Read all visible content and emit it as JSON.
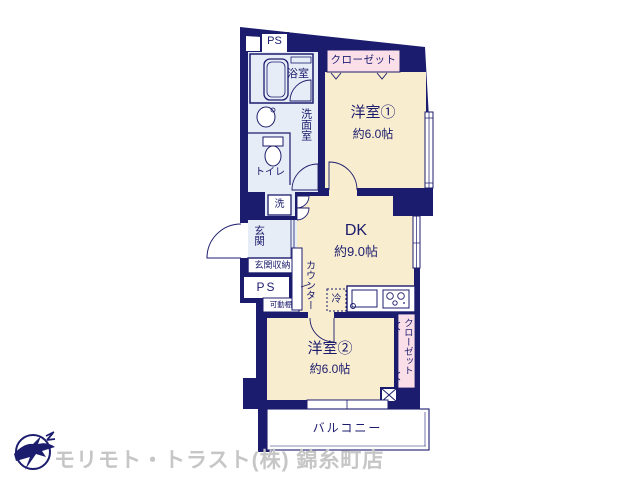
{
  "plan": {
    "rooms": {
      "room1": {
        "label": "洋室①",
        "size": "約6.0帖"
      },
      "dk": {
        "label": "DK",
        "size": "約9.0帖"
      },
      "room2": {
        "label": "洋室②",
        "size": "約6.0帖"
      }
    },
    "closet_top": {
      "label": "クローゼット"
    },
    "closet_right": {
      "label": "クローゼット"
    },
    "balcony": {
      "label": "バルコニー"
    },
    "bathroom": {
      "label": "浴室"
    },
    "washroom": {
      "label": "洗面室"
    },
    "toilet": {
      "label": "トイレ"
    },
    "entrance": {
      "label": "玄関"
    },
    "entrance_storage": {
      "label": "玄関収納"
    },
    "ps_top": {
      "label": "PS"
    },
    "ps_left": {
      "label": "PS"
    },
    "washer": {
      "label": "洗"
    },
    "fridge": {
      "label": "冷"
    },
    "counter": {
      "label": "カウンター"
    },
    "shelf": {
      "label": "可動棚"
    }
  },
  "footer": {
    "company": "モリモト・トラスト(株) 錦糸町店"
  },
  "colors": {
    "wall": "#1c1c6e",
    "room_floor": "#f8edcf",
    "closet": "#fadfe8",
    "water_area": "#e6edf6",
    "watermark": "#c6c6c6",
    "background": "#ffffff"
  }
}
